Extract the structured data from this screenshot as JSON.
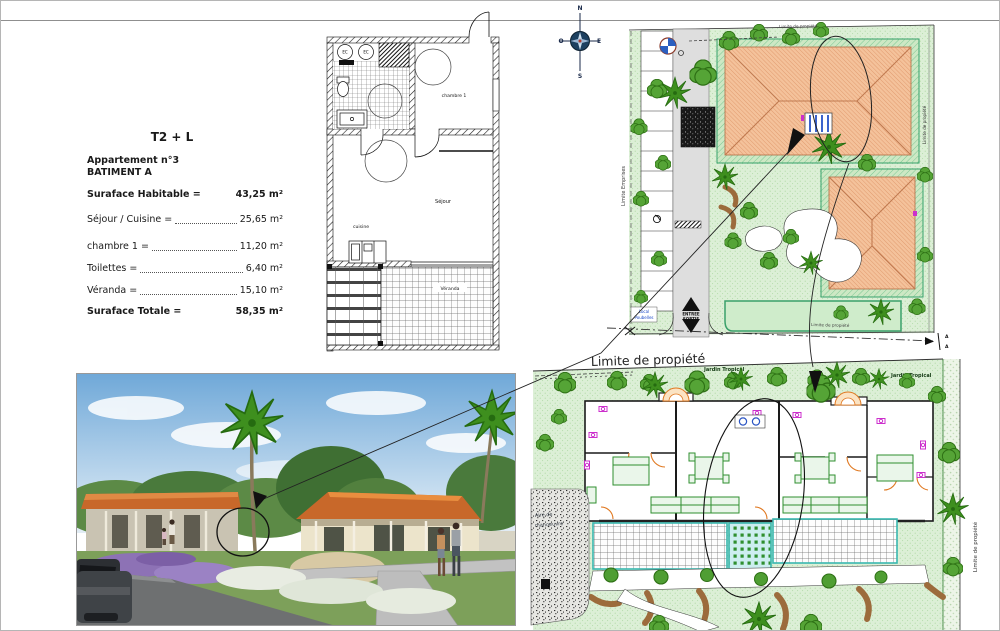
{
  "info_panel": {
    "title": "T2 + L",
    "apartment": "Appartement n°3",
    "building": "BATIMENT A",
    "rows": [
      {
        "label": "Suraface Habitable =",
        "value": "43,25 m²",
        "bold": true,
        "leader": false
      },
      {
        "label": "Séjour / Cuisine =",
        "value": "25,65 m²",
        "bold": false,
        "leader": true
      },
      {
        "label": "chambre 1 =",
        "value": "11,20 m²",
        "bold": false,
        "leader": true
      },
      {
        "label": "Toilettes =",
        "value": "6,40 m²",
        "bold": false,
        "leader": true
      },
      {
        "label": "Véranda =",
        "value": "15,10 m²",
        "bold": false,
        "leader": true
      },
      {
        "label": "Suraface Totale =",
        "value": "58,35 m²",
        "bold": true,
        "leader": false
      }
    ]
  },
  "floor_plan": {
    "bedroom": "chambre 1",
    "living": "Séjour",
    "kitchen": "cuisine",
    "veranda": "Véranda",
    "water_heater": "EC"
  },
  "compass": {
    "north": "N",
    "south": "S",
    "east": "E",
    "west": "O"
  },
  "site_plan": {
    "boundary_top": "Limite de propiété",
    "boundary_right": "Limite de propiété",
    "boundary_left": "Limite Emprises",
    "entrance_line1": "ENTREE",
    "entrance_line2": "SORTIE",
    "trash_line1": "Local",
    "trash_line2": "Poubelles"
  },
  "road": {
    "boundary_small": "Limite de propiété",
    "boundary_large": "Limite de propiété",
    "section_marker": "A"
  },
  "detail_plan": {
    "garden_label_1": "Jardin Tropical",
    "garden_label_2": "Jardin Tropical",
    "boundary_right": "Limite de propiété",
    "road_label_line1": "Aire de",
    "road_label_line2": "manoeuvre"
  },
  "colors": {
    "lawn": "#dcefd6",
    "roof": "#f4c29b",
    "roof_edge": "#b06a42",
    "tree_green": "#55a436",
    "terrace_teal": "#3ab8b0",
    "fixture_magenta": "#cc2fcc",
    "door_orange": "#e07820",
    "window_blue": "#3b63cc",
    "annotation": "#111111"
  }
}
